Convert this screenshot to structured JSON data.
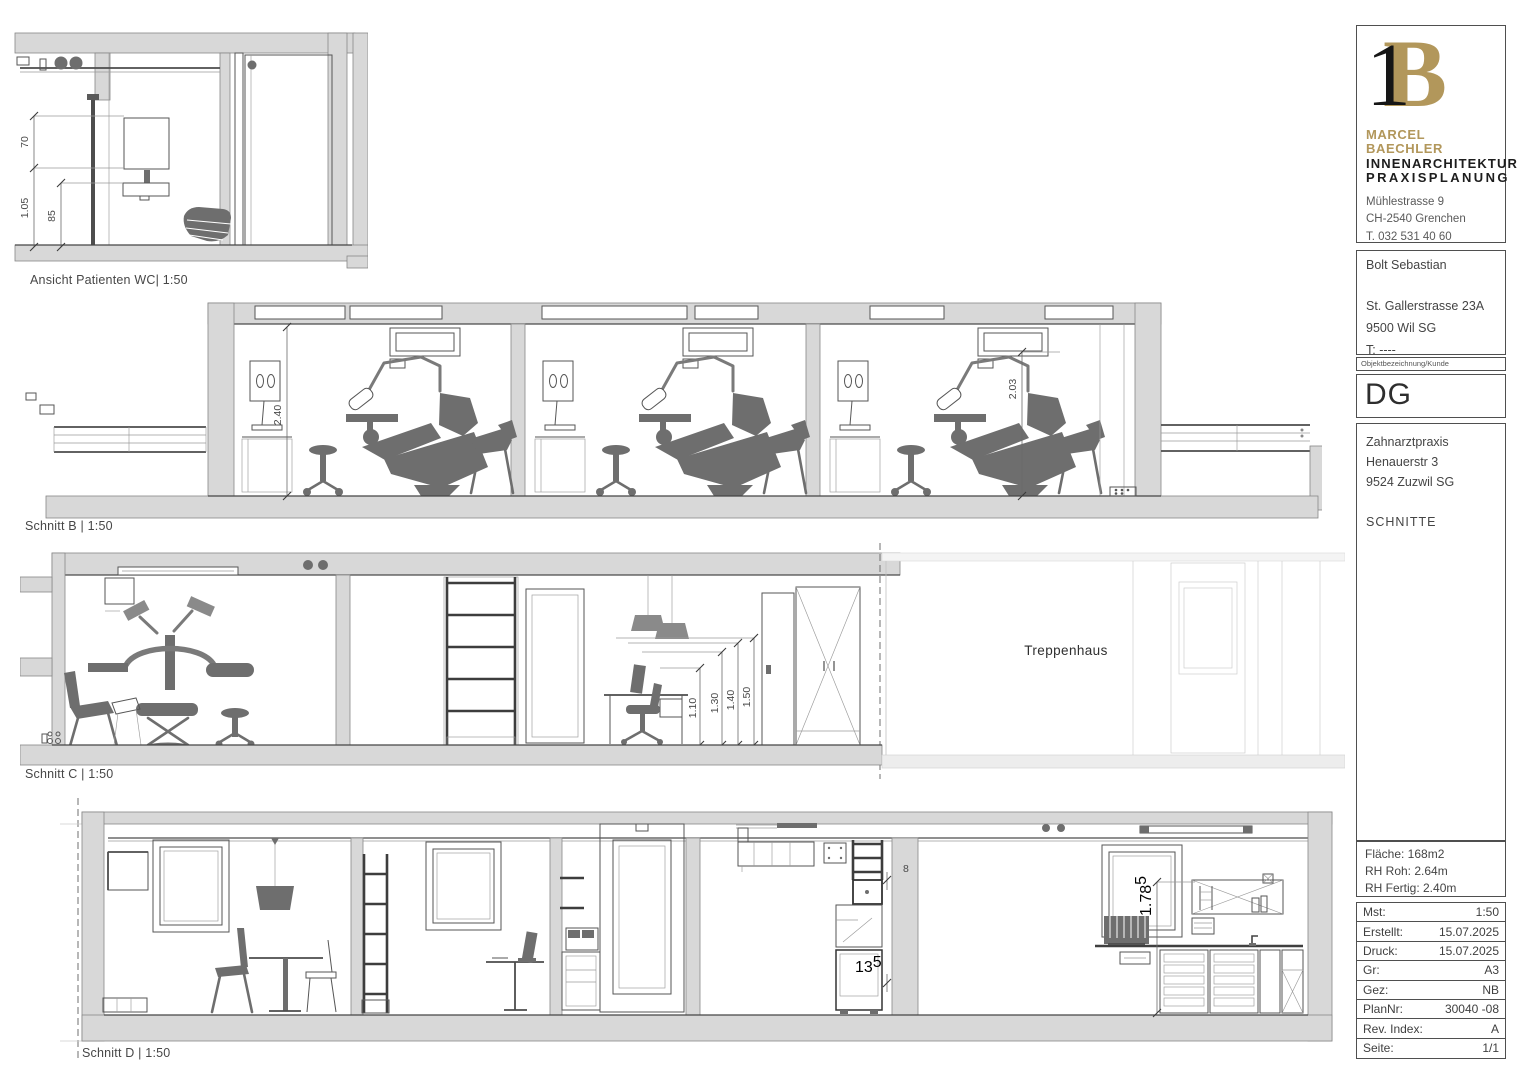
{
  "sheet": {
    "background": "#ffffff",
    "accent_gold": "#b2975b",
    "line_color": "#555555"
  },
  "architect": {
    "monogram_1": "1",
    "monogram_b": "B",
    "name": "MARCEL BAECHLER",
    "discipline": "INNENARCHITEKTUR",
    "specialty": "PRAXISPLANUNG",
    "street": "Mühlestrasse 9",
    "city": "CH-2540 Grenchen",
    "phone": "T. 032 531 40 60",
    "email": "office@mbaechler.ch",
    "website": "marcelbaechler.ch"
  },
  "client": {
    "name": "Bolt Sebastian",
    "street": "St. Gallerstrasse 23A",
    "city": "9500 Wil SG",
    "phone": "T: ----",
    "caption": "Objektbezeichnung/Kunde"
  },
  "floor_code": "DG",
  "project": {
    "name": "Zahnarztpraxis",
    "street": "Henauerstr 3",
    "city": "9524 Zuzwil SG",
    "plan_type": "SCHNITTE",
    "area": "Fläche: 168m2",
    "rh_roh": "RH Roh: 2.64m",
    "rh_fertig": "RH Fertig: 2.40m"
  },
  "details": [
    {
      "label": "Mst:",
      "value": "1:50"
    },
    {
      "label": "Erstellt:",
      "value": "15.07.2025"
    },
    {
      "label": "Druck:",
      "value": "15.07.2025"
    },
    {
      "label": "Gr:",
      "value": "A3"
    },
    {
      "label": "Gez:",
      "value": "NB"
    },
    {
      "label": "PlanNr:",
      "value": "30040 -08"
    },
    {
      "label": "Rev. Index:",
      "value": "A"
    },
    {
      "label": "Seite:",
      "value": "1/1"
    }
  ],
  "views": {
    "wc": {
      "label": "Ansicht Patienten WC| 1:50",
      "dims": {
        "mirror": "70",
        "total": "1.05",
        "sink": "85"
      }
    },
    "schnitt_b": {
      "label": "Schnitt B | 1:50",
      "dims": {
        "room_height": "2.40",
        "door_height": "2.03"
      }
    },
    "schnitt_c": {
      "label": "Schnitt C | 1:50",
      "room": "Treppenhaus",
      "dims": {
        "d1": "1.10",
        "d2": "1.30",
        "d3": "1.40",
        "d4": "1.50"
      }
    },
    "schnitt_d": {
      "label": "Schnitt D | 1:50",
      "dims": {
        "shelf_gap": "8",
        "plinth": "13",
        "plinth_sup": "5",
        "counter_height": "1.78",
        "counter_sup": "5"
      }
    }
  }
}
